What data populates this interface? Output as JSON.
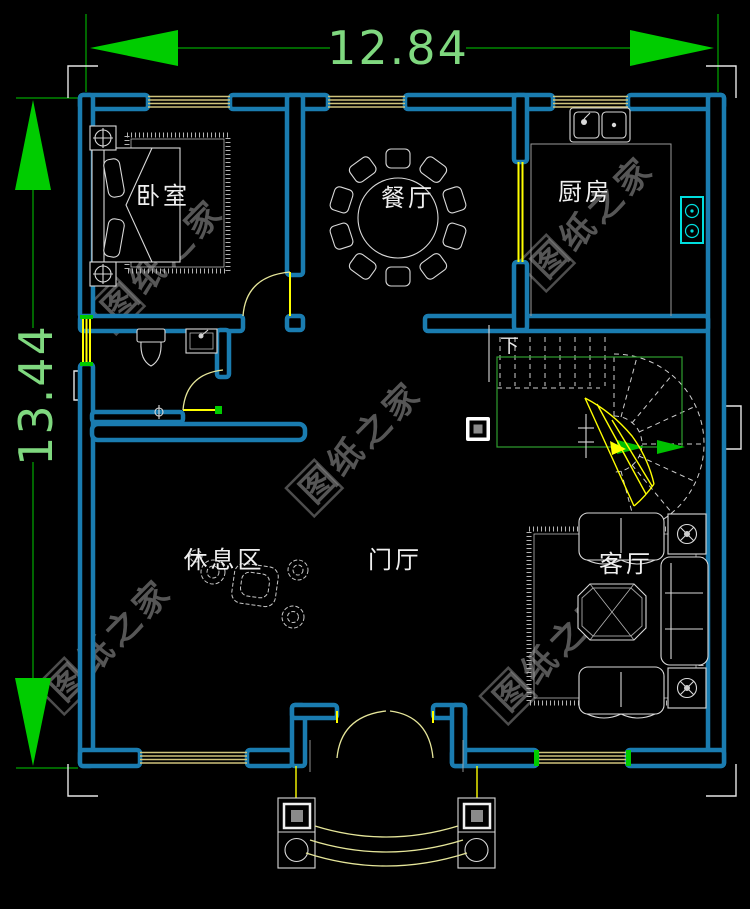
{
  "dimensions": {
    "top": "12.84",
    "left": "13.44"
  },
  "rooms": {
    "bedroom": "卧室",
    "dining_room": "餐厅",
    "kitchen": "厨房",
    "rest_area": "休息区",
    "entrance_hall": "门厅",
    "living_room": "客厅"
  },
  "stairs": {
    "direction_label": "下"
  },
  "watermark": {
    "text": "图纸之家"
  },
  "colors": {
    "background": "#000000",
    "wall": "#1a7cb0",
    "window": "#cfc37c",
    "door_yellow": "#ffff00",
    "door_arc": "#e6e69a",
    "dimension": "#00cc00",
    "dimension_text": "#7fd87f",
    "furniture": "#d9d9d9",
    "stove": "#00dede",
    "stair_guide": "#2f9e2f",
    "window_cap": "#00cc00",
    "watermark": "#8c8c8c"
  }
}
